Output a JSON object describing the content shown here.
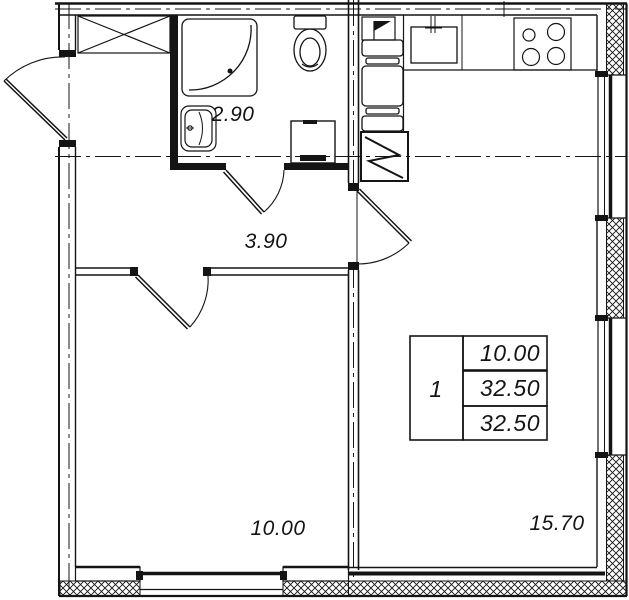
{
  "plan": {
    "title": "one-room apartment floor plan",
    "colors": {
      "ink": "#141414",
      "background": "#ffffff"
    },
    "rooms": {
      "bathroom": {
        "area": "2.90"
      },
      "hallway": {
        "area": "3.90"
      },
      "bedroom": {
        "area": "10.00"
      },
      "living_kitchen": {
        "area": "15.70"
      }
    },
    "info_table": {
      "apartment_number": "1",
      "rows": [
        "10.00",
        "32.50",
        "32.50"
      ]
    },
    "icons": [
      "shower-tray",
      "toilet",
      "washbasin",
      "washing-machine",
      "wardrobe",
      "kitchen-sink",
      "cooktop",
      "water-heater",
      "electrical-panel",
      "entry-door",
      "interior-door",
      "window"
    ]
  }
}
